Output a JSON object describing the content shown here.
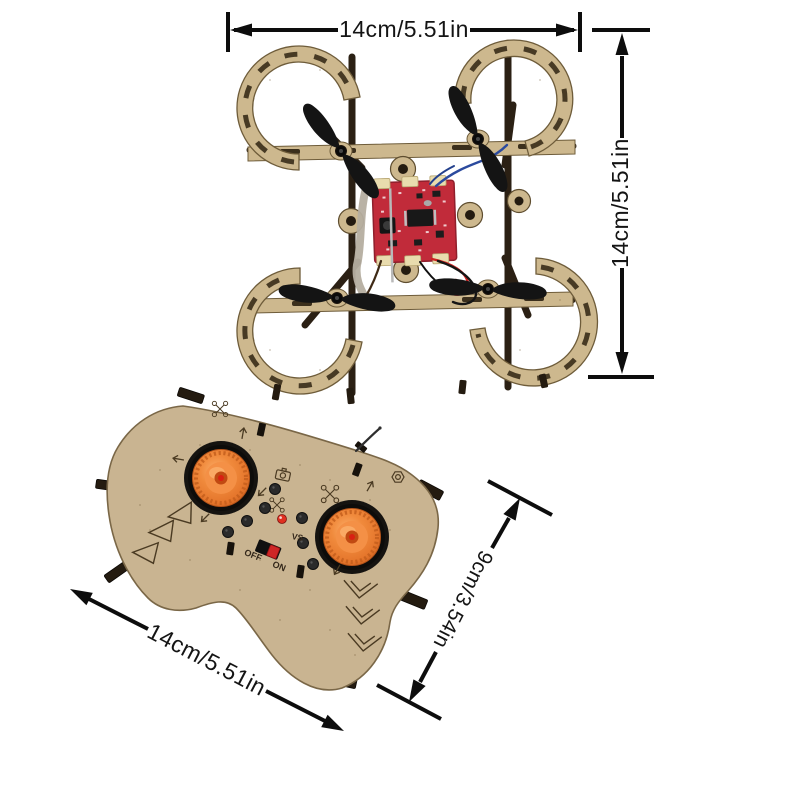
{
  "scene": {
    "background": "#ffffff"
  },
  "annotations": {
    "color": "#0d0d0d",
    "drone_width_label": "14cm/5.51in",
    "drone_height_label": "14cm/5.51in",
    "controller_width_label": "14cm/5.51in",
    "controller_depth_label": "9cm/3.54in"
  },
  "drone": {
    "wood_color": "#cdb88e",
    "rod_color": "#2b2014",
    "pcb_color": "#c12b3a",
    "propeller_color": "#161616"
  },
  "controller": {
    "body_color": "#c9b491",
    "joystick_color": "#ef8136",
    "well_color": "#151310",
    "led_color": "#e03020",
    "power_switch_knob_color": "#cf2626",
    "labels": {
      "off": "OFF",
      "on": "ON",
      "vs": "VS"
    }
  }
}
